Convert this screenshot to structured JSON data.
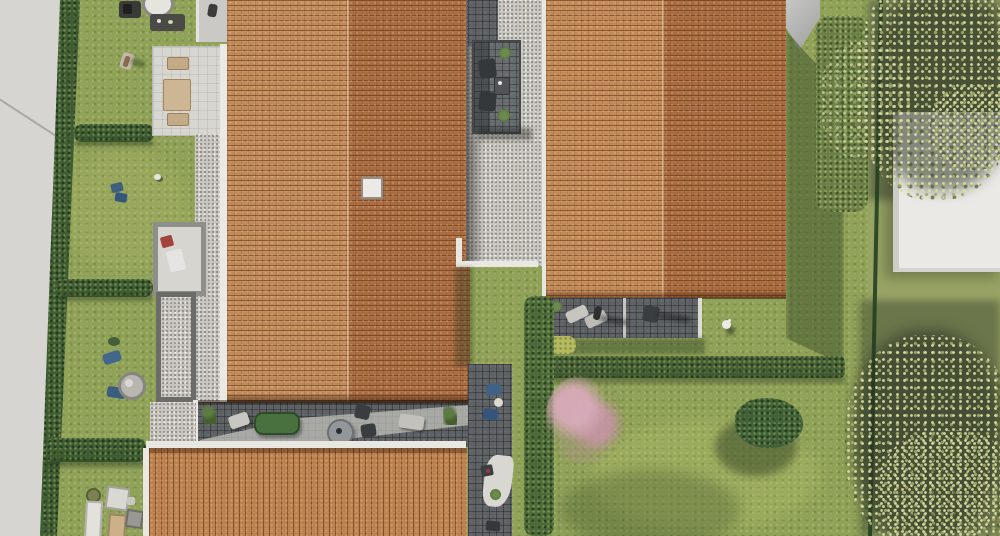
{
  "meta": {
    "type": "aerial-architectural-rendering",
    "description": "Top-down photorealistic rendering of a residential development: two large terracotta tile roofs (left and right buildings), a third roof at the bottom edge, gravel paths, dark tiled terraces with garden furniture, private lawns separated by hedges, a light grey street along the left edge and a neighbouring parcel with a white building and large trees on the right behind a fence."
  },
  "palette": {
    "street": "#d7d5d1",
    "lawn": "#90a258",
    "hedge_dark": "#3f5c34",
    "roof_slope_light": "#c28a57",
    "roof_slope_dark": "#a96b3f",
    "roof_bottom_building": "#ba7f4d",
    "gravel": "#c8c5bf",
    "terrace_tile": "#5e6265",
    "wall_white": "#e9e7e2",
    "tree_foliage_light": "#dcd8aa",
    "pink_tree": "#cfa0b0",
    "furniture_blue": "#3f6285",
    "sofa_green": "#49703f",
    "neighbor_building": "#eae9e5"
  },
  "objects": [
    {
      "name": "street",
      "desc": "light grey road strip, left edge, slightly tapering"
    },
    {
      "name": "street-hedge",
      "desc": "dark green hedge line along the street"
    },
    {
      "name": "left-garden",
      "desc": "four lawn sections divided by low hedges with BBQ, sunbathing people, blue loungers, round table, shed and storage boxes"
    },
    {
      "name": "building-1-roof",
      "desc": "large terracotta roof, vertical ridge, skylight square"
    },
    {
      "name": "picnic-terrace",
      "desc": "light paved terrace with picnic table and two benches"
    },
    {
      "name": "balcony-top",
      "desc": "small light terrace at top edge with a person"
    },
    {
      "name": "gravel-corridor",
      "desc": "gravel strip between the two buildings"
    },
    {
      "name": "corridor-terrace",
      "desc": "dark tiled terrace with two cube chairs, table and plants"
    },
    {
      "name": "building-2-roof",
      "desc": "second terracotta roof reaching the top edge, grey gable at its right"
    },
    {
      "name": "building-2-terrace",
      "desc": "dark tiled terrace with pale loungers, person and chair"
    },
    {
      "name": "right-garden",
      "desc": "large lawn with hedge rows, pink flowering tree, shrub and white garden ornament"
    },
    {
      "name": "boundary-fence",
      "desc": "thin dark fence line between parcels"
    },
    {
      "name": "hedge-band-right",
      "desc": "wide green hedge band near the fence"
    },
    {
      "name": "neighbor-building",
      "desc": "white flat-roofed building on the neighbouring parcel"
    },
    {
      "name": "tree-top-right",
      "desc": "large speckled tree canopy over the neighbour parcel, top right"
    },
    {
      "name": "tree-bottom-right",
      "desc": "second large tree canopy, bottom right"
    },
    {
      "name": "lower-terrace-strip",
      "desc": "dark tiled terrace band with green sofa, round table, loungers, chairs and plants"
    },
    {
      "name": "building-3-roof",
      "desc": "bottom terracotta roof with vertical tile columns, cut by image edge"
    },
    {
      "name": "bottom-path",
      "desc": "dark tiled path with blue chairs, white patio patch and plants"
    }
  ]
}
